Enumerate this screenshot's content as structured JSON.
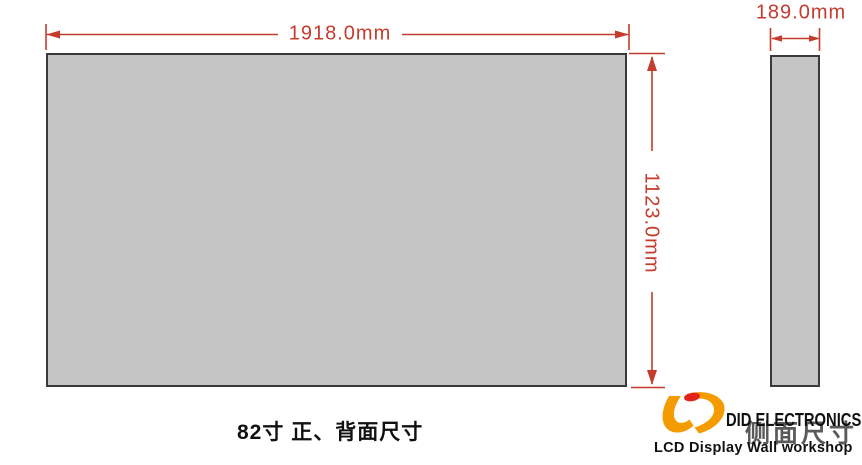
{
  "drawing": {
    "front_view": {
      "caption": "82寸 正、背面尺寸",
      "width_label": "1918.0mm",
      "height_label": "1123.0mm"
    },
    "side_view": {
      "caption": "侧面尺寸",
      "depth_label": "189.0mm"
    },
    "colors": {
      "dimension_red": "#c53b2c",
      "panel_fill": "#c5c5c5",
      "panel_border": "#3a3a3a",
      "logo_orange": "#f49b00",
      "logo_dot_red": "#e2231a",
      "caption_black": "#111111",
      "side_caption_gray": "#5a5a5a"
    }
  },
  "logo": {
    "company": "DID ELECTRONICS",
    "tagline": "LCD Display Wall workshop"
  }
}
